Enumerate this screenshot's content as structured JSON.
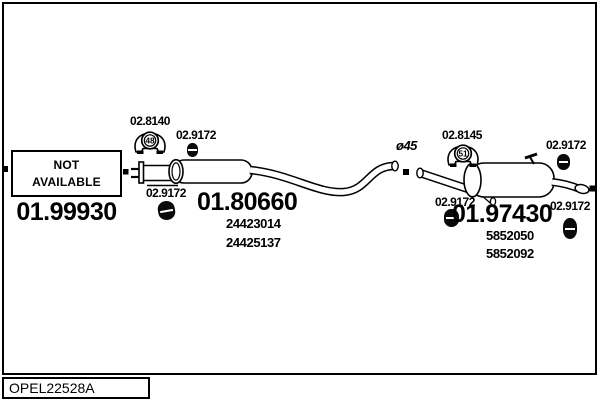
{
  "drawing_code": "OPEL22528A",
  "not_available_box": "NOT AVAILABLE",
  "pipe_diameter_label": "ø45",
  "clamp": {
    "part_number": "02.9172"
  },
  "front_gasket": {
    "part_number": "02.8140",
    "bore": "48"
  },
  "rear_gasket": {
    "part_number": "02.8145",
    "bore": "51"
  },
  "front_section": {
    "part_number": "01.99930"
  },
  "middle_silencer": {
    "part_number": "01.80660",
    "oe_numbers": [
      "24423014",
      "24425137"
    ]
  },
  "rear_silencer": {
    "part_number": "01.97430",
    "oe_numbers": [
      "5852050",
      "5852092"
    ]
  },
  "colors": {
    "ink": "#000000",
    "paper": "#ffffff"
  }
}
